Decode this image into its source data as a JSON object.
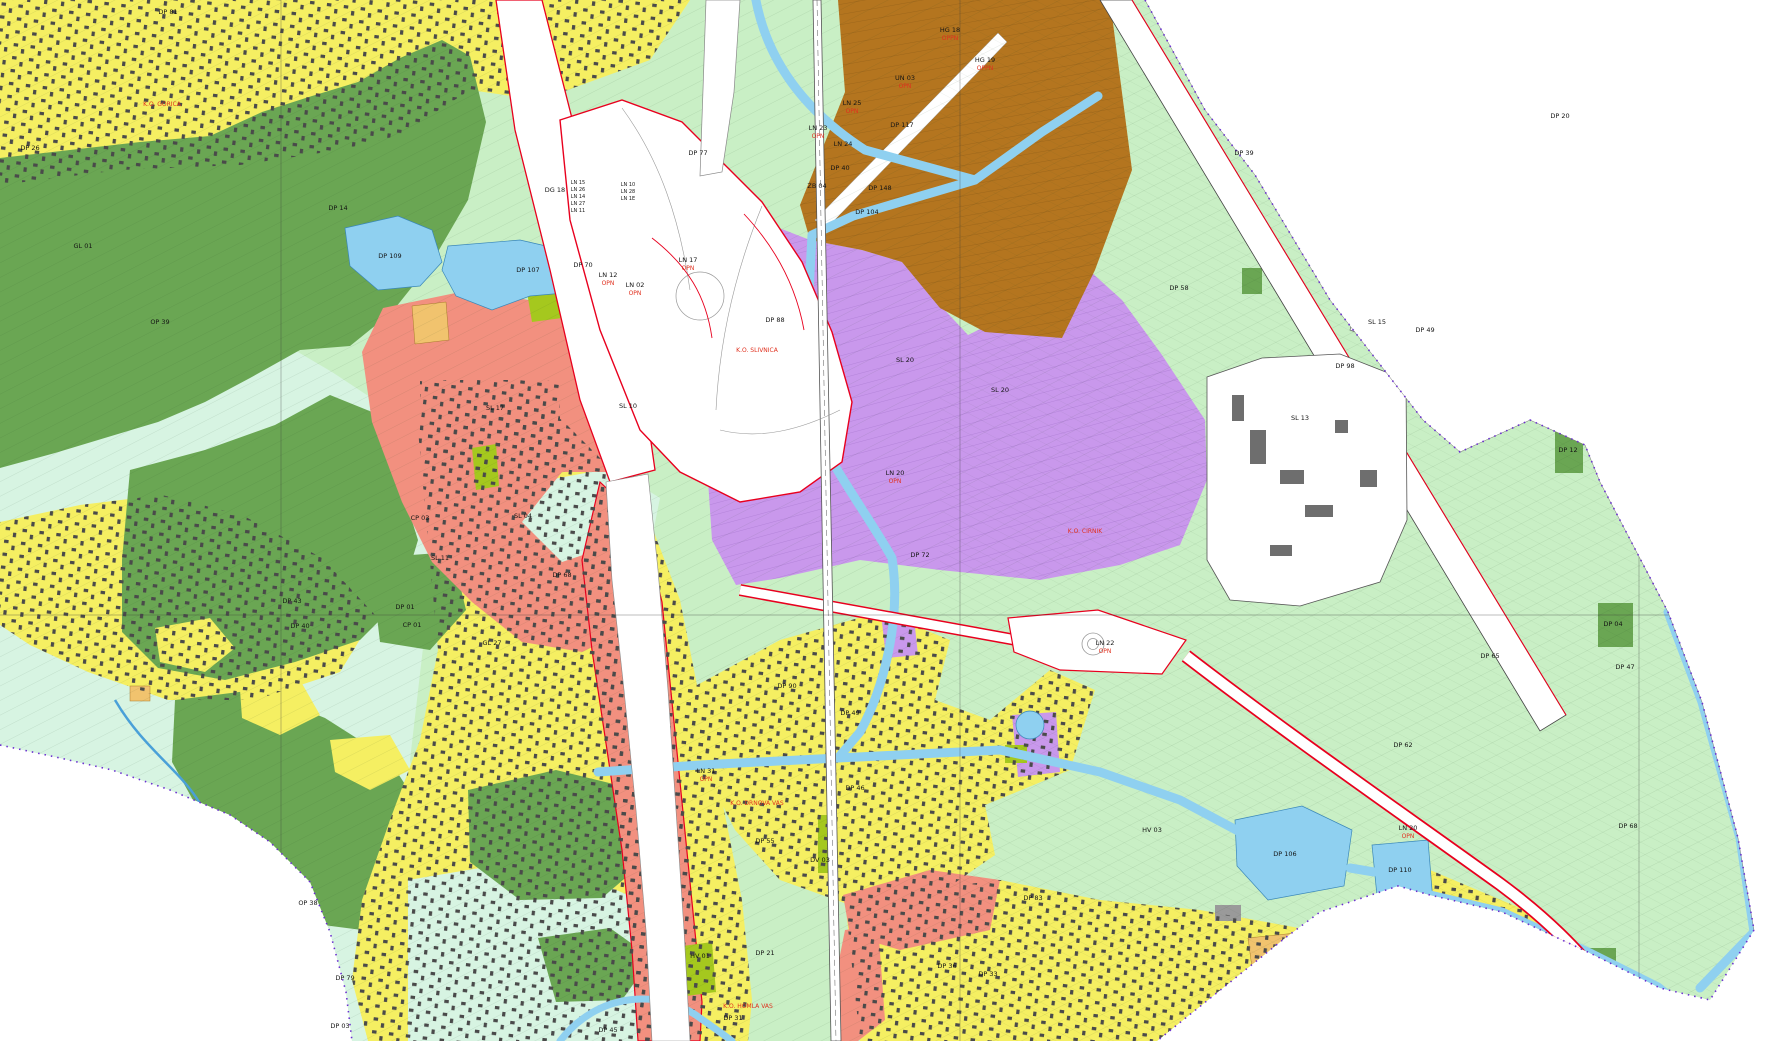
{
  "map": {
    "title": "Municipal spatial zoning plan — cadastral map view",
    "palette": {
      "base-green": "#c9efc5",
      "mint": "#d7f4e2",
      "forest": "#6aa653",
      "yellow": "#f5ef62",
      "salmon": "#f2907f",
      "purple": "#c998ec",
      "brown": "#b4751f",
      "water": "#8fd0f0",
      "chartreuse": "#a5c81e",
      "tan": "#f1c36e",
      "building": "#4a4a4a",
      "road-white": "#ffffff",
      "red-line": "#e8001e",
      "boundary-purple": "#6a2fd0",
      "grid-gray": "#3a3a3a"
    },
    "grid": {
      "x": [
        281,
        960,
        1639
      ],
      "y": [
        615
      ]
    },
    "labels": [
      {
        "text": "DP 81",
        "x": 168,
        "y": 14
      },
      {
        "text": "DP 26",
        "x": 30,
        "y": 150
      },
      {
        "text": "GL 01",
        "x": 83,
        "y": 248
      },
      {
        "text": "OP 39",
        "x": 160,
        "y": 324
      },
      {
        "text": "DP 14",
        "x": 338,
        "y": 210
      },
      {
        "text": "DP 109",
        "x": 390,
        "y": 258
      },
      {
        "text": "DP 107",
        "x": 528,
        "y": 272
      },
      {
        "text": "DP 43",
        "x": 292,
        "y": 603
      },
      {
        "text": "DP 40",
        "x": 300,
        "y": 628
      },
      {
        "text": "OP 38",
        "x": 308,
        "y": 905
      },
      {
        "text": "DP 79",
        "x": 345,
        "y": 980
      },
      {
        "text": "DP 03",
        "x": 340,
        "y": 1028
      },
      {
        "text": "DP 45",
        "x": 608,
        "y": 1032
      },
      {
        "text": "DP 31",
        "x": 733,
        "y": 1020
      },
      {
        "text": "DP 36",
        "x": 947,
        "y": 968
      },
      {
        "text": "DP 33",
        "x": 988,
        "y": 976
      },
      {
        "text": "SL 17",
        "x": 495,
        "y": 410
      },
      {
        "text": "SL 11",
        "x": 440,
        "y": 560
      },
      {
        "text": "SL 04",
        "x": 523,
        "y": 518
      },
      {
        "text": "DP 68",
        "x": 562,
        "y": 577
      },
      {
        "text": "CP 03",
        "x": 420,
        "y": 520
      },
      {
        "text": "DP 01",
        "x": 405,
        "y": 609
      },
      {
        "text": "CP 01",
        "x": 412,
        "y": 627
      },
      {
        "text": "GL 27",
        "x": 492,
        "y": 645
      },
      {
        "text": "SL 10",
        "x": 628,
        "y": 408
      },
      {
        "text": "DP 70",
        "x": 583,
        "y": 267
      },
      {
        "text": "DG 18",
        "x": 555,
        "y": 192
      },
      {
        "text": "DP 77",
        "x": 698,
        "y": 155
      },
      {
        "text": "DP 88",
        "x": 775,
        "y": 322
      },
      {
        "text": "DP 117",
        "x": 902,
        "y": 127
      },
      {
        "text": "DP 40",
        "x": 840,
        "y": 170
      },
      {
        "text": "DP 148",
        "x": 880,
        "y": 190
      },
      {
        "text": "DP 104",
        "x": 867,
        "y": 214
      },
      {
        "text": "ZB 04",
        "x": 817,
        "y": 188
      },
      {
        "text": "SL 20",
        "x": 905,
        "y": 362
      },
      {
        "text": "SL 20",
        "x": 1000,
        "y": 392
      },
      {
        "text": "DP 72",
        "x": 920,
        "y": 557
      },
      {
        "text": "DP 90",
        "x": 787,
        "y": 688
      },
      {
        "text": "DP 49",
        "x": 850,
        "y": 715
      },
      {
        "text": "DP 46",
        "x": 855,
        "y": 790
      },
      {
        "text": "DP 55",
        "x": 765,
        "y": 843
      },
      {
        "text": "DV 03",
        "x": 820,
        "y": 862
      },
      {
        "text": "DP 21",
        "x": 765,
        "y": 955
      },
      {
        "text": "HV 01",
        "x": 700,
        "y": 958
      },
      {
        "text": "HV 03",
        "x": 1152,
        "y": 832
      },
      {
        "text": "DP 83",
        "x": 1033,
        "y": 900
      },
      {
        "text": "DP 106",
        "x": 1285,
        "y": 856
      },
      {
        "text": "DP 110",
        "x": 1400,
        "y": 872
      },
      {
        "text": "DP 39",
        "x": 1244,
        "y": 155
      },
      {
        "text": "DP 58",
        "x": 1179,
        "y": 290
      },
      {
        "text": "DP 98",
        "x": 1345,
        "y": 368
      },
      {
        "text": "SL 13",
        "x": 1300,
        "y": 420
      },
      {
        "text": "SL 15",
        "x": 1377,
        "y": 324
      },
      {
        "text": "DP 49",
        "x": 1425,
        "y": 332
      },
      {
        "text": "DP 12",
        "x": 1568,
        "y": 452
      },
      {
        "text": "DP 20",
        "x": 1560,
        "y": 118
      },
      {
        "text": "DP 62",
        "x": 1403,
        "y": 747
      },
      {
        "text": "DP 65",
        "x": 1490,
        "y": 658
      },
      {
        "text": "DP 04",
        "x": 1613,
        "y": 626
      },
      {
        "text": "DP 47",
        "x": 1625,
        "y": 669
      },
      {
        "text": "DP 68",
        "x": 1628,
        "y": 828
      },
      {
        "text": "LN 12",
        "x": 608,
        "y": 277
      },
      {
        "text": "OPN",
        "x": 608,
        "y": 285,
        "cls": "r"
      },
      {
        "text": "LN 02",
        "x": 635,
        "y": 287
      },
      {
        "text": "OPN",
        "x": 635,
        "y": 295,
        "cls": "r"
      },
      {
        "text": "LN 17",
        "x": 688,
        "y": 262
      },
      {
        "text": "OPN",
        "x": 688,
        "y": 270,
        "cls": "r"
      },
      {
        "text": "LN 25",
        "x": 852,
        "y": 105
      },
      {
        "text": "OPN",
        "x": 852,
        "y": 113,
        "cls": "r"
      },
      {
        "text": "LN 23",
        "x": 818,
        "y": 130
      },
      {
        "text": "OPN",
        "x": 818,
        "y": 138,
        "cls": "r"
      },
      {
        "text": "LN 24",
        "x": 843,
        "y": 146
      },
      {
        "text": "UN 03",
        "x": 905,
        "y": 80
      },
      {
        "text": "OPN",
        "x": 905,
        "y": 88,
        "cls": "r"
      },
      {
        "text": "LN 20",
        "x": 895,
        "y": 475
      },
      {
        "text": "OPN",
        "x": 895,
        "y": 483,
        "cls": "r"
      },
      {
        "text": "LN 20",
        "x": 1408,
        "y": 830
      },
      {
        "text": "OPN",
        "x": 1408,
        "y": 838,
        "cls": "r"
      },
      {
        "text": "LN 31",
        "x": 706,
        "y": 773
      },
      {
        "text": "OPN",
        "x": 706,
        "y": 781,
        "cls": "r"
      },
      {
        "text": "LN 22",
        "x": 1105,
        "y": 645
      },
      {
        "text": "OPN",
        "x": 1105,
        "y": 653,
        "cls": "r"
      },
      {
        "text": "HG 18",
        "x": 950,
        "y": 32
      },
      {
        "text": "OPPN",
        "x": 950,
        "y": 40,
        "cls": "r"
      },
      {
        "text": "HG 19",
        "x": 985,
        "y": 62
      },
      {
        "text": "OPPN",
        "x": 985,
        "y": 70,
        "cls": "r"
      },
      {
        "text": "LN 10",
        "x": 628,
        "y": 186,
        "cls": "s"
      },
      {
        "text": "LN 28",
        "x": 628,
        "y": 193,
        "cls": "s"
      },
      {
        "text": "LN 1E",
        "x": 628,
        "y": 200,
        "cls": "s"
      },
      {
        "text": "LN 15",
        "x": 578,
        "y": 184,
        "cls": "s"
      },
      {
        "text": "LN 26",
        "x": 578,
        "y": 191,
        "cls": "s"
      },
      {
        "text": "LN 14",
        "x": 578,
        "y": 198,
        "cls": "s"
      },
      {
        "text": "LN 27",
        "x": 578,
        "y": 205,
        "cls": "s"
      },
      {
        "text": "LN 11",
        "x": 578,
        "y": 212,
        "cls": "s"
      },
      {
        "text": "K.O. SLIVNICA",
        "x": 757,
        "y": 352,
        "cls": "r"
      },
      {
        "text": "K.O. DRNOVA VAS",
        "x": 757,
        "y": 805,
        "cls": "r"
      },
      {
        "text": "K.O. HOMLA VAS",
        "x": 748,
        "y": 1008,
        "cls": "r"
      },
      {
        "text": "K.O. GORICA",
        "x": 162,
        "y": 106,
        "cls": "r"
      },
      {
        "text": "K.O. CIRNIK",
        "x": 1085,
        "y": 533,
        "cls": "r"
      }
    ]
  }
}
